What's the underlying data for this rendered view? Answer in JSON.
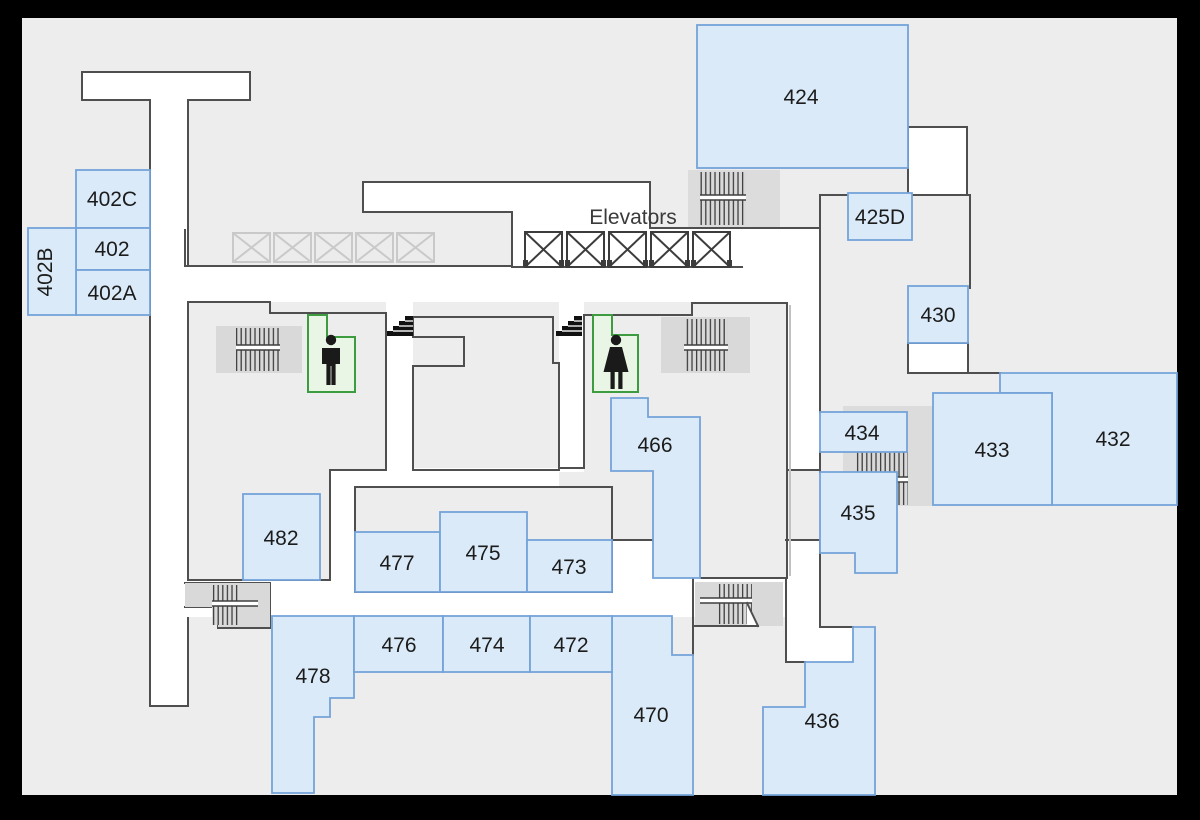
{
  "map": {
    "title": "building-floor-plan",
    "labels": {
      "elevators": "Elevators"
    },
    "rooms": {
      "402": "402",
      "402A": "402A",
      "402B": "402B",
      "402C": "402C",
      "424": "424",
      "425D": "425D",
      "430": "430",
      "432": "432",
      "433": "433",
      "434": "434",
      "435": "435",
      "436": "436",
      "466": "466",
      "470": "470",
      "472": "472",
      "473": "473",
      "474": "474",
      "475": "475",
      "476": "476",
      "477": "477",
      "478": "478",
      "482": "482"
    },
    "icons": {
      "mens_restroom": "male-figure",
      "womens_restroom": "female-figure",
      "stairs": "hatched-stairs",
      "elevator": "boxed-x",
      "steps": "mini-staircase"
    },
    "counts": {
      "elevators": 5,
      "phantom_elevators": 5,
      "stairways": 6,
      "restrooms": 2
    },
    "colors": {
      "frame": "#000000",
      "background": "#ededed",
      "corridor": "#ffffff",
      "wall": "#4f4f4f",
      "room_fill": "#daeaf8",
      "room_border": "#74a3d9",
      "restroom_fill": "#e9f6e5",
      "restroom_border": "#3d9c40",
      "stairs_fill": "#d9d9d9"
    }
  }
}
